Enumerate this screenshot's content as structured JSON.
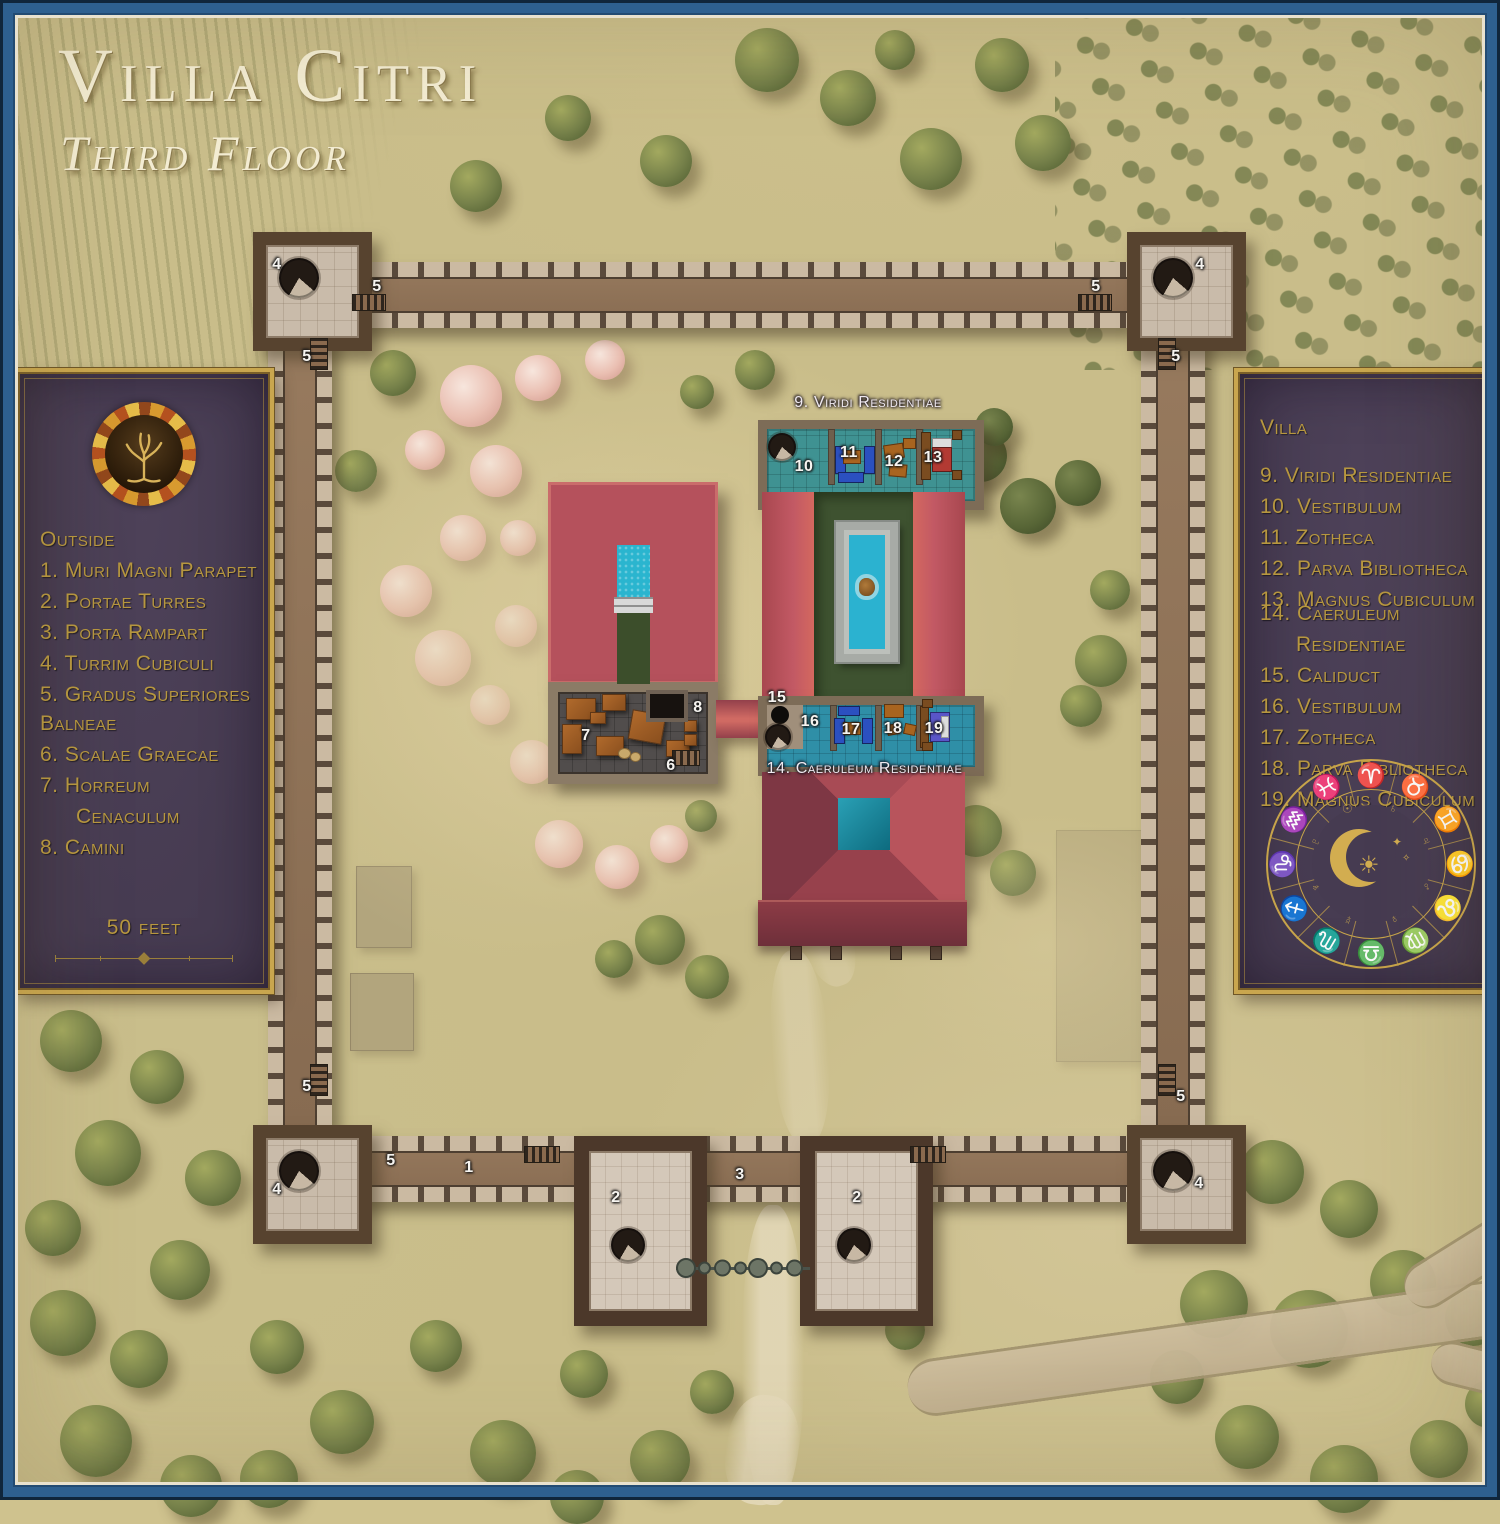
{
  "title": {
    "main": "Villa Citri",
    "subtitle": "Third Floor"
  },
  "legend_left": {
    "sections": [
      {
        "heading": "Outside",
        "items": [
          "1. Muri Magni Parapet",
          "2. Portae Turres",
          "3. Porta Rampart",
          "4. Turrim Cubiculi",
          "5. Gradus Superiores"
        ]
      },
      {
        "heading": "Balneae",
        "items": [
          "6. Scalae Graecae",
          "7. Horreum",
          "Cenaculum",
          "8. Camini"
        ]
      }
    ],
    "scale_label": "50 feet",
    "emblem": "autumn-tree-emblem"
  },
  "legend_right": {
    "heading": "Villa",
    "sections": [
      {
        "items": [
          "9. Viridi Residentiae",
          "10.  Vestibulum",
          "11.  Zotheca",
          "12. Parva Bibliotheca",
          "13. Magnus Cubiculum"
        ]
      },
      {
        "items": [
          "14. Caeruleum",
          "Residentiae",
          "15. Caliduct",
          "16. Vestibulum",
          "17. Zotheca",
          "18. Parva Bibliotheca",
          "19. Magnus Cubiculum"
        ]
      }
    ],
    "zodiac": {
      "signs": [
        "♈",
        "♉",
        "♊",
        "♋",
        "♌",
        "♍",
        "♎",
        "♏",
        "♐",
        "♑",
        "♒",
        "♓"
      ],
      "planets": [
        "♄",
        "♃",
        "♂",
        "♀",
        "☿",
        "♆",
        "♇",
        "☉"
      ],
      "sun": "☀",
      "sparkle": "✦",
      "sparkle_small": "✧"
    }
  },
  "map": {
    "labels": {
      "viridi": "9. Viridi Residentiae",
      "caeruleum": "14. Caeruleum Residentiae"
    },
    "markers": {
      "n1": "1",
      "n2": "2",
      "n3": "3",
      "n4": "4",
      "n5": "5",
      "n6": "6",
      "n7": "7",
      "n8": "8",
      "n10": "10",
      "n11": "11",
      "n12": "12",
      "n13": "13",
      "n15": "15",
      "n16": "16",
      "n17": "17",
      "n18": "18",
      "n19": "19"
    }
  },
  "colors": {
    "frame_blue": "#2e6090",
    "panel_purple": "#463b51",
    "accent_gold": "#b7973f",
    "roof_red": "#b5515c",
    "pool_teal": "#2bb2d0",
    "ground_tan": "#c9bd8a",
    "text_cream": "#f3ecd2"
  }
}
